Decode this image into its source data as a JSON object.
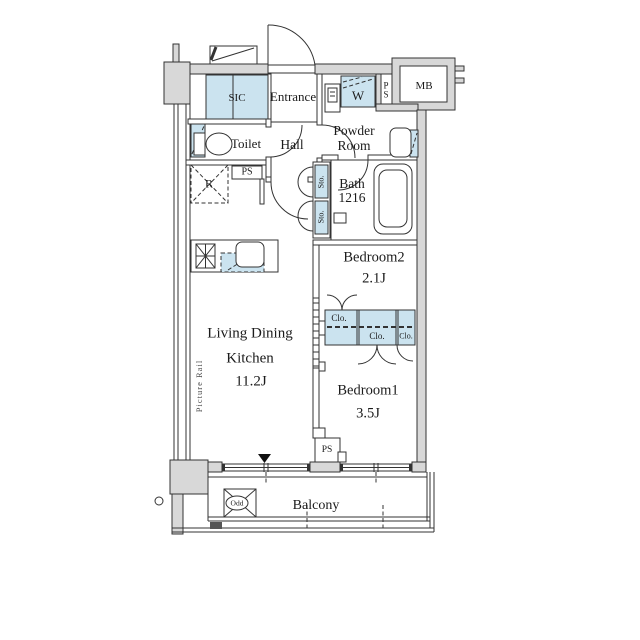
{
  "plan": {
    "type": "apartment-floor-plan",
    "rooms": {
      "sic": "SIC",
      "entrance": "Entrance",
      "toilet": "Toilet",
      "hall": "Hall",
      "powder_line1": "Powder",
      "powder_line2": "Room",
      "bath_line1": "Bath",
      "bath_line2": "1216",
      "bedroom2": "Bedroom2",
      "bedroom2_size": "2.1J",
      "bedroom1": "Bedroom1",
      "bedroom1_size": "3.5J",
      "ldk_line1": "Living Dining",
      "ldk_line2": "Kitchen",
      "ldk_size": "11.2J",
      "balcony": "Balcony"
    },
    "labels": {
      "mb": "MB",
      "ps": "PS",
      "w": "W",
      "r": "R",
      "sto": "Sto.",
      "clo": "Clo.",
      "picture_rail": "Picture Rail",
      "odd": "Odd"
    },
    "fixtures": [
      "entrance-door",
      "shoe-closet",
      "water-heater",
      "washing-machine-space",
      "meter-box",
      "toilet",
      "washbasin",
      "bathtub",
      "storage",
      "refrigerator-space",
      "kitchen-counter",
      "gas-stove",
      "kitchen-sink",
      "closet",
      "sliding-door",
      "windows",
      "evacuation-hatch",
      "drain",
      "pipe-space"
    ],
    "colors": {
      "fixture_blue": "#cbe3ef",
      "wall_gray": "#d8d8d8",
      "line": "#333333"
    }
  }
}
